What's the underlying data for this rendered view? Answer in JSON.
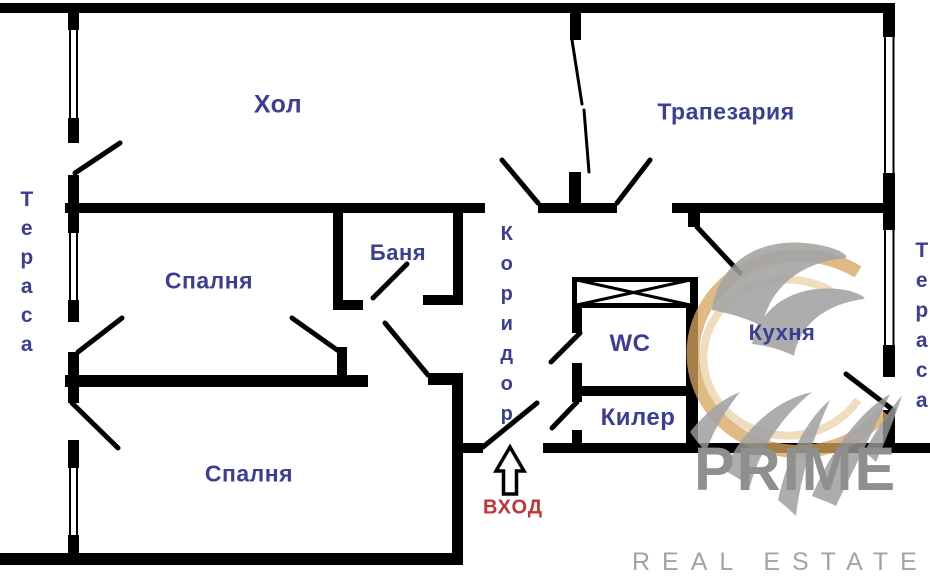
{
  "plan_title": "apartment-floor-plan",
  "rooms": {
    "hall": "Хол",
    "dining": "Трапезария",
    "bedroom_top": "Спалня",
    "bedroom_bottom": "Спалня",
    "bath": "Баня",
    "wc": "WC",
    "pantry": "Килер",
    "kitchen": "Кухня",
    "corridor": "Коридор",
    "terrace_left": "Тераса",
    "terrace_right": "Тераса"
  },
  "entrance": {
    "label": "ВХОД"
  },
  "watermark": {
    "brand": "PRIME",
    "tagline": "REAL ESTATE"
  },
  "colors": {
    "wall": "#000000",
    "room_label": "#3a3f94",
    "entrance_red": "#c53434",
    "watermark_gray": "#8f8f8f",
    "tagline_gray": "#a3a3a3",
    "logo_tan": "#d7a560",
    "logo_tan_light": "#e9d0a2",
    "logo_gray": "#9b9b9b"
  }
}
